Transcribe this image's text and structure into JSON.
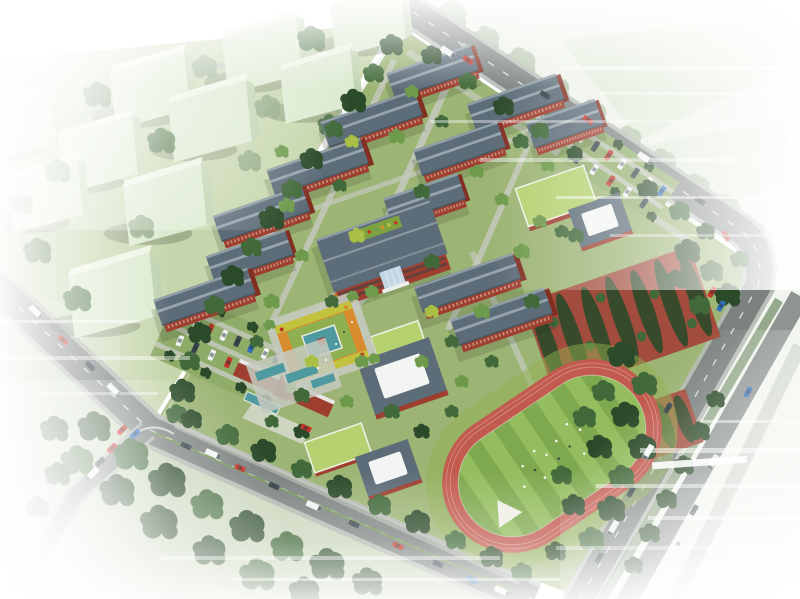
{
  "meta": {
    "subject": "Aerial bird's-eye architectural rendering of a school campus master plan",
    "canvas": {
      "width": 800,
      "height": 599
    },
    "visible_text": []
  },
  "palette": {
    "road": "#7b8280",
    "road_edge": "#b4b9b1",
    "lane": "#ffffff",
    "roof": "#5c6c78",
    "ridge": "#95a4ad",
    "brick": "#9e3e2f",
    "brick_dark": "#822f23",
    "glass": "#c2d6e4",
    "tower_face": "#dcead0",
    "tower_side": "#bed2ae",
    "tower_top": "#edf5e5",
    "lawn": "#9cb474",
    "lawn_pale": "#bccf9e",
    "lawn_bright": "#8fb050",
    "tree_dark": "#2b4a29",
    "tree_mid": "#41693a",
    "tree_light": "#6d9a4b",
    "tree_wash": "#8aa47e",
    "tree_accent": "#a9bf45",
    "track": "#c25a4e",
    "field": "#7fa94e",
    "field_stripe": "#93bd5e",
    "water": "#4f9aa0",
    "orchard": "#a14c3c",
    "garden_orange": "#d88c2e",
    "garden_yellow": "#c2c23e",
    "green_roof": "#b5d170",
    "skylight": "#f3f5f2",
    "paving": "#c6cabf",
    "shadow": "#1c2b1a",
    "white": "#ffffff",
    "car_red": "#c43427",
    "car_dark": "#39454b",
    "car_blue": "#2f6fc1",
    "car_white": "#f2f4f4",
    "canal": "#9fb9c6",
    "median_green": "#76a04c",
    "crop_row": "#2f6f62"
  },
  "scene": {
    "residential_block": {
      "towers": 10,
      "description": "pale green high-rise massing slabs on lawns northwest of campus"
    },
    "campus": {
      "classroom_slabs": 12,
      "main_building": {
        "features": [
          "gray hipped roof",
          "rooftop garden",
          "red brick walls",
          "glass atrium entrance"
        ]
      },
      "green_roof_buildings": 3,
      "skylight_halls": 3,
      "running_track": {
        "lanes": "red",
        "infield": "striped green with athletes",
        "long_jump_pit": true
      },
      "orchard_groves": 2,
      "crop_plot_rows": 5,
      "central_garden": {
        "pond": true,
        "pavilion": true,
        "planting": [
          "orange",
          "yellow"
        ]
      },
      "reflecting_pools": 3,
      "entrance_gate": {
        "location": "southwest",
        "forecourt_pool": true
      },
      "parking_lots": 2
    },
    "roads": [
      "northeast arterial curving into east road",
      "southeast boulevard with tree median",
      "southwest arterial with green centerline",
      "south branch road"
    ],
    "vehicles_visible": 36,
    "atmosphere": "edges fade to white with horizontal motion streaks"
  }
}
